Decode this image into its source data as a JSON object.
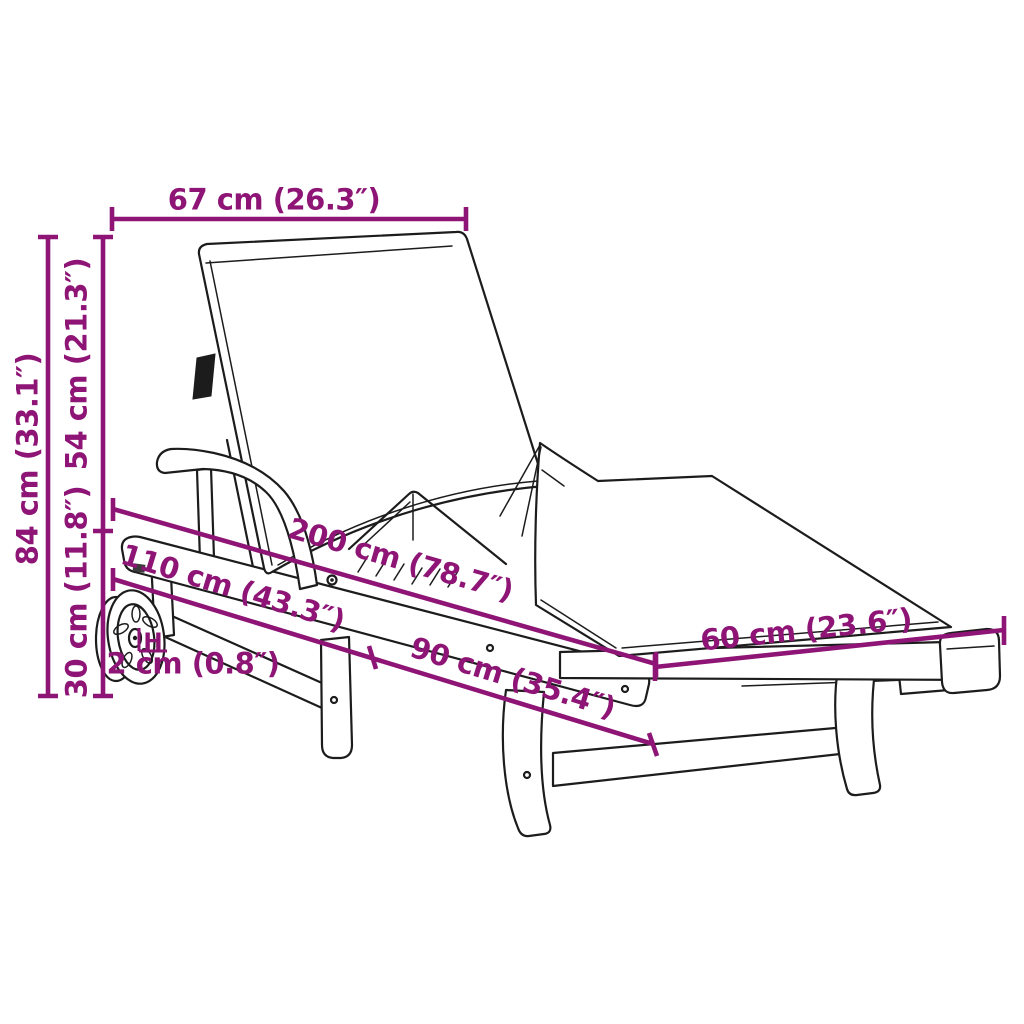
{
  "diagram": {
    "title": "Sun lounger with cushion and wheels - dimension diagram",
    "colors": {
      "dimension_accent": "#8e1576",
      "line_art": "#1c1c1c",
      "background": "#ffffff"
    },
    "measurements": {
      "backrest_width": "67 cm (26.3″)",
      "total_height": "84 cm (33.1″)",
      "backrest_height": "54 cm (21.3″)",
      "base_height": "30 cm (11.8″)",
      "total_length": "200 cm (78.7″)",
      "front_section_length": "110 cm (43.3″)",
      "rear_section_length": "90 cm (35.4″)",
      "width": "60 cm (23.6″)",
      "wheel_clearance": "2 cm (0.8″)",
      "hub_marker": "H"
    }
  }
}
